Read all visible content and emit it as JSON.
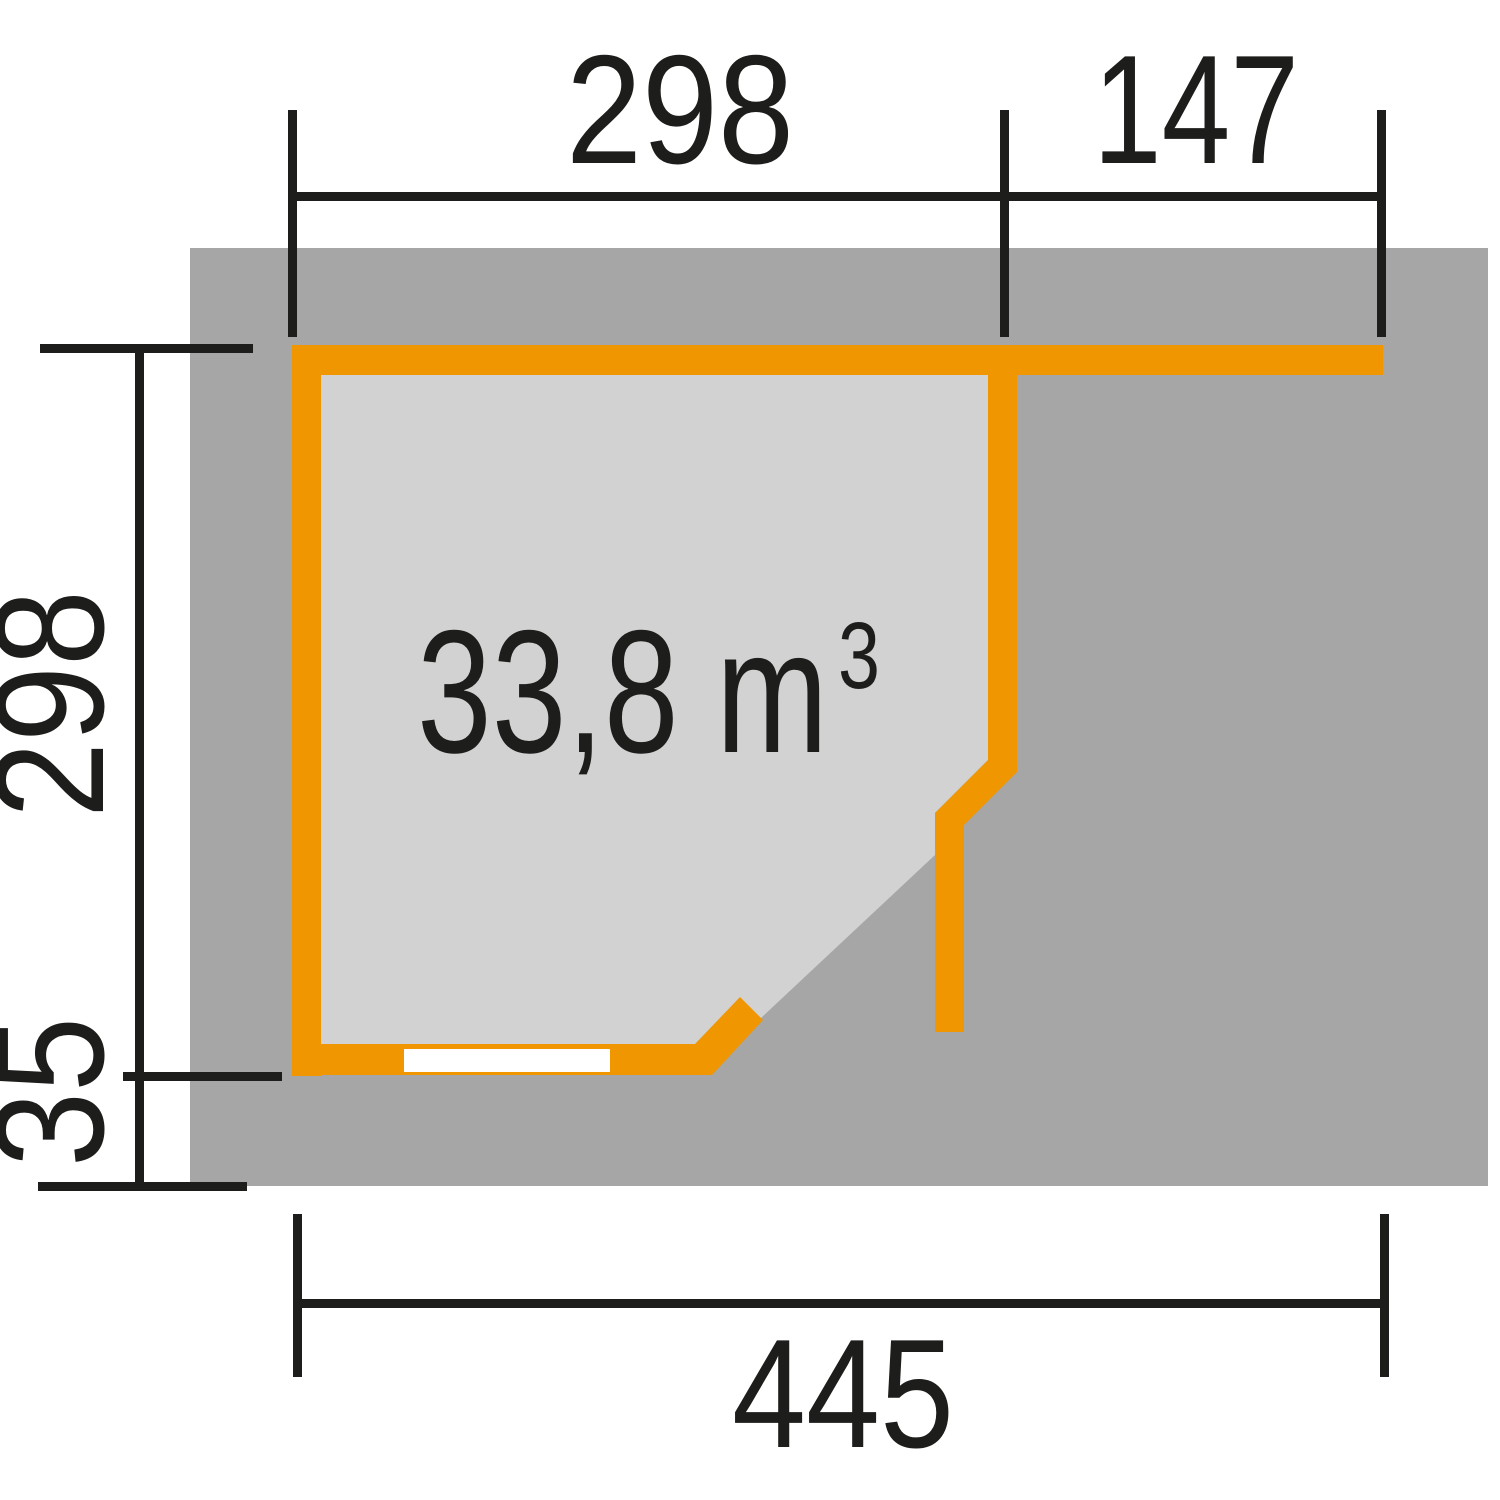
{
  "colors": {
    "wall_orange": "#ef9600",
    "base_slab_gray": "#a6a6a6",
    "floor_gray": "#d2d2d2",
    "ink": "#1d1d1b",
    "window_white": "#ffffff",
    "background": "#ffffff"
  },
  "dimensions": {
    "top_room_width": "298",
    "top_side_extension": "147",
    "left_room_depth": "298",
    "left_roof_overhang": "35",
    "bottom_total_width": "445"
  },
  "volume": {
    "value": "33,8 m",
    "sup": "3"
  }
}
